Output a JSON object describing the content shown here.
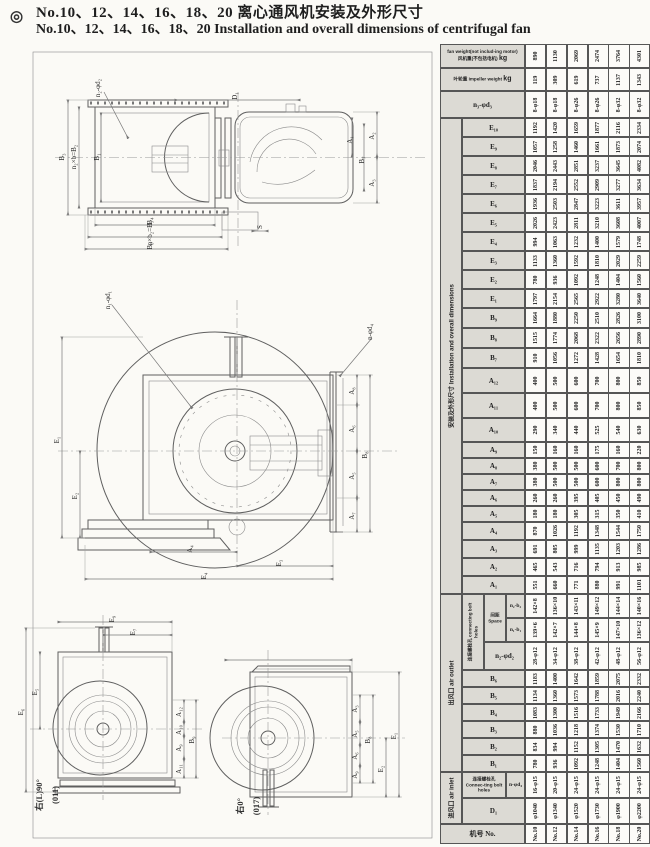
{
  "title": {
    "bullet": "◎",
    "zh": "No.10、12、14、16、18、20 离心通风机安装及外形尺寸",
    "en": "No.10、12、14、16、18、20 Installation and overall dimensions of centrifugal fan"
  },
  "captions": {
    "left": {
      "line1": "右(L)90°",
      "line2": "(011)"
    },
    "right": {
      "line1": "右0°",
      "line2": "(017)"
    }
  },
  "drawing_labels": {
    "top_view": [
      "n₂-φd₂",
      "B₃",
      "n₂×b=B₂",
      "B₁",
      "D₁",
      "A₂",
      "A₁",
      "B₇",
      "A₃",
      "B₄",
      "n×b₂=B₅",
      "B₆",
      "S"
    ],
    "front_view": [
      "n₁-φd₁",
      "n-φd₄",
      "E₁",
      "E₂",
      "A₄",
      "E₃",
      "E₄",
      "A₈",
      "A₆",
      "A₅",
      "A₇",
      "B₈"
    ],
    "left_small": [
      "E₉",
      "E₇",
      "E₅",
      "E₆",
      "A₁₂",
      "A₁₀",
      "A₉",
      "A₁₁",
      "B₉"
    ],
    "right_small": [
      "A₃",
      "A₅",
      "A₆",
      "A₉",
      "B₈",
      "E₂",
      "E₁"
    ]
  },
  "table": {
    "row_header": "机号 No.",
    "fan_sizes": [
      "No.10",
      "No.12",
      "No.14",
      "No.16",
      "No.18",
      "No.20"
    ],
    "groups": {
      "install": "安装及外形尺寸 Installation and overall dimensions",
      "outlet": "出风口 air outlet",
      "inlet": "进风口 air inlet",
      "bolt_outlet": "连接螺栓孔 connecting bolt holes",
      "space": "间距 Space",
      "bolt_inlet": "连接螺栓孔 Connec-ting bolt holes"
    },
    "weight_rows": {
      "fan_en": "fan weight(not includ-ing motor)",
      "fan_zh": "风机重(不包括电机)",
      "imp_zh": "叶轮重",
      "imp_en": "impeller weight",
      "unit": "kg"
    },
    "rows": [
      {
        "label": "",
        "kind": "fan",
        "values": [
          "890",
          "1130",
          "2069",
          "2474",
          "3764",
          "4301"
        ]
      },
      {
        "label": "",
        "kind": "imp",
        "values": [
          "119",
          "309",
          "619",
          "737",
          "1137",
          "1343"
        ]
      },
      {
        "label": "n₃-φd₃",
        "kind": "full",
        "values": [
          "8-φ18",
          "8-φ18",
          "8-φ26",
          "8-φ26",
          "8-φ32",
          "8-φ32"
        ]
      },
      {
        "label": "E₁₀",
        "kind": "plain",
        "values": [
          "1192",
          "1420",
          "1659",
          "1877",
          "2116",
          "2334"
        ]
      },
      {
        "label": "E₉",
        "kind": "plain",
        "values": [
          "1057",
          "1258",
          "1460",
          "1661",
          "1873",
          "2074"
        ]
      },
      {
        "label": "E₈",
        "kind": "plain",
        "values": [
          "2046",
          "2443",
          "2851",
          "3237",
          "3645",
          "4082"
        ]
      },
      {
        "label": "E₇",
        "kind": "plain",
        "values": [
          "1837",
          "2194",
          "2552",
          "2909",
          "3277",
          "3634"
        ]
      },
      {
        "label": "E₆",
        "kind": "plain",
        "values": [
          "1936",
          "2503",
          "2847",
          "3223",
          "3611",
          "3957"
        ]
      },
      {
        "label": "E₅",
        "kind": "plain",
        "values": [
          "2026",
          "2423",
          "2811",
          "3210",
          "3608",
          "4007"
        ]
      },
      {
        "label": "E₄",
        "kind": "plain",
        "values": [
          "994",
          "1063",
          "1232",
          "1400",
          "1579",
          "1748"
        ]
      },
      {
        "label": "E₃",
        "kind": "plain",
        "values": [
          "1133",
          "1360",
          "1592",
          "1810",
          "2029",
          "2259"
        ]
      },
      {
        "label": "E₂",
        "kind": "plain",
        "values": [
          "780",
          "936",
          "1092",
          "1248",
          "1404",
          "1560"
        ]
      },
      {
        "label": "E₁",
        "kind": "plain",
        "values": [
          "1797",
          "2154",
          "2565",
          "2922",
          "3280",
          "3640"
        ]
      },
      {
        "label": "B₉",
        "kind": "plain",
        "values": [
          "1664",
          "1880",
          "2250",
          "2510",
          "2826",
          "3100"
        ]
      },
      {
        "label": "B₈",
        "kind": "plain",
        "values": [
          "1515",
          "1774",
          "2068",
          "2322",
          "2656",
          "2890"
        ]
      },
      {
        "label": "B₇",
        "kind": "plain",
        "values": [
          "910",
          "1056",
          "1272",
          "1428",
          "1654",
          "1810"
        ]
      },
      {
        "label": "A₁₂",
        "kind": "plain",
        "values": [
          "400",
          "500",
          "600",
          "700",
          "800",
          "850"
        ]
      },
      {
        "label": "A₁₁",
        "kind": "plain",
        "values": [
          "400",
          "500",
          "600",
          "700",
          "800",
          "850"
        ]
      },
      {
        "label": "A₁₀",
        "kind": "plain",
        "values": [
          "290",
          "340",
          "440",
          "525",
          "540",
          "630"
        ]
      },
      {
        "label": "A₉",
        "kind": "plain",
        "values": [
          "150",
          "160",
          "160",
          "175",
          "160",
          "220"
        ]
      },
      {
        "label": "A₈",
        "kind": "plain",
        "values": [
          "380",
          "500",
          "500",
          "600",
          "700",
          "800"
        ]
      },
      {
        "label": "A₇",
        "kind": "plain",
        "values": [
          "380",
          "500",
          "500",
          "600",
          "800",
          "800"
        ]
      },
      {
        "label": "A₆",
        "kind": "plain",
        "values": [
          "260",
          "260",
          "395",
          "405",
          "450",
          "490"
        ]
      },
      {
        "label": "A₅",
        "kind": "plain",
        "values": [
          "180",
          "180",
          "305",
          "315",
          "350",
          "410"
        ]
      },
      {
        "label": "A₄",
        "kind": "plain",
        "values": [
          "870",
          "1026",
          "1192",
          "1348",
          "1544",
          "1750"
        ]
      },
      {
        "label": "A₃",
        "kind": "plain",
        "values": [
          "691",
          "805",
          "999",
          "1135",
          "1203",
          "1286"
        ]
      },
      {
        "label": "A₂",
        "kind": "plain",
        "values": [
          "465",
          "543",
          "716",
          "794",
          "913",
          "985"
        ]
      },
      {
        "label": "A₁",
        "kind": "plain",
        "values": [
          "551",
          "660",
          "771",
          "880",
          "991",
          "1101"
        ]
      },
      {
        "label": "n₂-b₂",
        "kind": "spacing",
        "values": [
          "142×8",
          "136×10",
          "143×11",
          "149×12",
          "144×14",
          "140×16"
        ]
      },
      {
        "label": "n₁-b₁",
        "kind": "spacing",
        "values": [
          "139×6",
          "142×7",
          "144×8",
          "145×9",
          "147×10",
          "136×12"
        ]
      },
      {
        "label": "n₂-φd₂",
        "kind": "bolt2",
        "values": [
          "28-φ12",
          "34-φ12",
          "38-φ12",
          "42-φ12",
          "48-φ12",
          "56-φ12"
        ]
      },
      {
        "label": "B₆",
        "kind": "plain",
        "values": [
          "1183",
          "1400",
          "1642",
          "1859",
          "2075",
          "2332"
        ]
      },
      {
        "label": "B₅",
        "kind": "plain",
        "values": [
          "1134",
          "1360",
          "1573",
          "1788",
          "2016",
          "2240"
        ]
      },
      {
        "label": "B₄",
        "kind": "plain",
        "values": [
          "1083",
          "1300",
          "1516",
          "1733",
          "1949",
          "2166"
        ]
      },
      {
        "label": "B₃",
        "kind": "plain",
        "values": [
          "880",
          "1036",
          "1218",
          "1374",
          "1530",
          "1710"
        ]
      },
      {
        "label": "B₂",
        "kind": "plain",
        "values": [
          "834",
          "994",
          "1152",
          "1305",
          "1470",
          "1632"
        ]
      },
      {
        "label": "B₁",
        "kind": "plain",
        "values": [
          "780",
          "936",
          "1092",
          "1248",
          "1404",
          "1560"
        ]
      },
      {
        "label": "n-φd₄",
        "kind": "inlet",
        "values": [
          "16-φ15",
          "20-φ15",
          "24-φ15",
          "24-φ15",
          "24-φ15",
          "24-φ15"
        ]
      },
      {
        "label": "D₁",
        "kind": "plain",
        "values": [
          "φ1040",
          "φ1340",
          "φ1520",
          "φ1730",
          "φ1900",
          "φ2200"
        ]
      },
      {
        "label": "",
        "kind": "no",
        "values": [
          "No.10",
          "No.12",
          "No.14",
          "No.16",
          "No.18",
          "No.20"
        ]
      }
    ]
  }
}
